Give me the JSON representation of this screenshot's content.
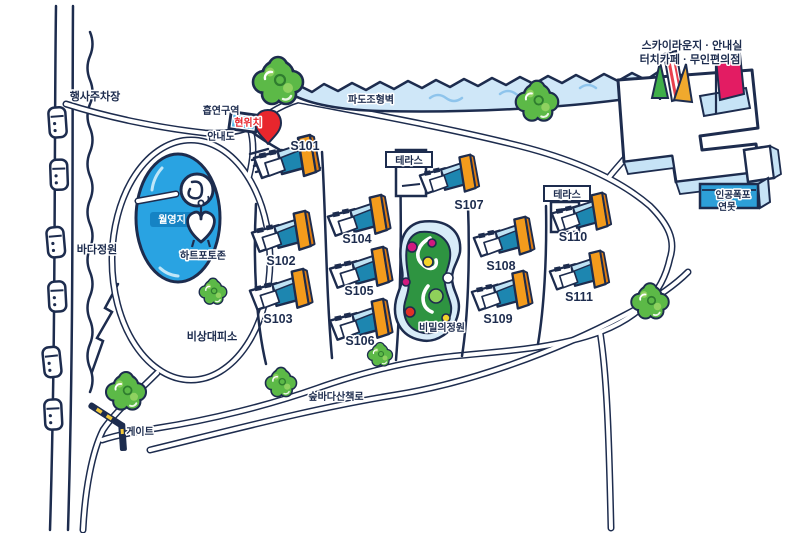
{
  "map": {
    "labels": {
      "event_parking": "행사주차장",
      "smoking_area": "흡연구역",
      "info_board": "안내도",
      "current_location": "현위치",
      "wave_wall": "파도조형벽",
      "sky_lounge_line1": "스카이라운지 · 안내실",
      "sky_lounge_line2": "터치카페 · 무인편의점",
      "artificial_waterfall_line1": "인공폭포",
      "artificial_waterfall_line2": "연못",
      "pond": "월영지",
      "heart_photo_zone": "하트포토존",
      "sea_garden": "바다정원",
      "emergency_shelter": "비상대피소",
      "gate": "게이트",
      "forest_trail": "숲바다산책로",
      "secret_garden": "비밀의정원",
      "terrace_s107": "테라스",
      "terrace_s110": "테라스"
    },
    "buildings": [
      {
        "label": "S101"
      },
      {
        "label": "S102"
      },
      {
        "label": "S103"
      },
      {
        "label": "S104"
      },
      {
        "label": "S105"
      },
      {
        "label": "S106"
      },
      {
        "label": "S107"
      },
      {
        "label": "S108"
      },
      {
        "label": "S109"
      },
      {
        "label": "S110"
      },
      {
        "label": "S111"
      }
    ],
    "colors": {
      "outline_navy": "#1d2c4e",
      "pond_blue": "#29a3e2",
      "pond_chip_blue": "#1583c4",
      "light_blue": "#cfe7f8",
      "tree_green": "#5cb947",
      "tree_green_light": "#8fd160",
      "cabin_blue": "#1d86b0",
      "cabin_blue_dark": "#0b6e97",
      "cabin_orange": "#f39b1c",
      "marker_red": "#e8262d",
      "flag_pink": "#e31c63",
      "flag_yellow": "#f0a92d",
      "flag_green": "#3fae49",
      "garden_green": "#2e9441",
      "flower_pink": "#d1197e",
      "flower_yellow": "#f3d32c",
      "flower_red": "#e03127"
    }
  }
}
